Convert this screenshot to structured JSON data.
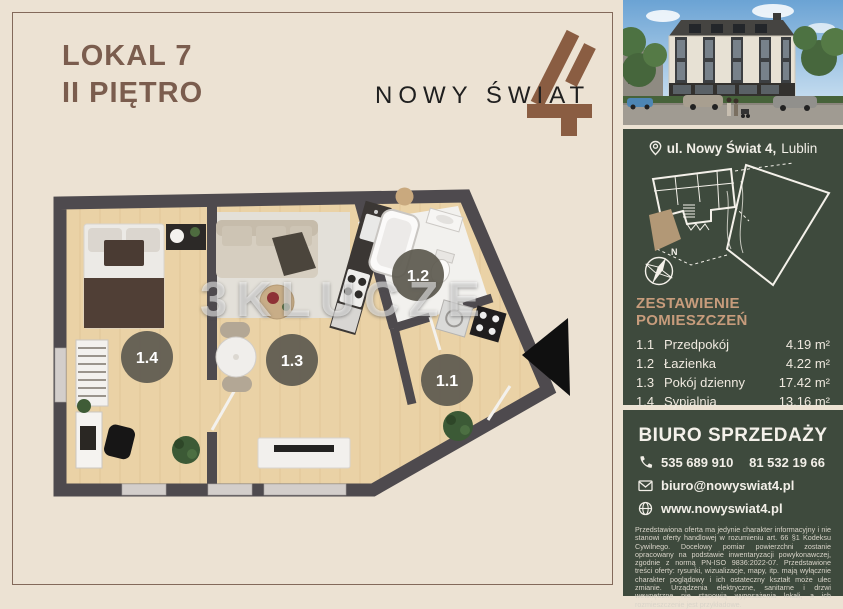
{
  "colors": {
    "background": "#ece2d3",
    "panel_green": "#3e4a3d",
    "accent_tan": "#c79c7c",
    "title_brown": "#7b5d4e",
    "logo_brown": "#8a5d42",
    "wall_gray": "#4e4a4e",
    "highlight_unit_tan": "#b29876"
  },
  "header": {
    "unit": "LOKAL 7",
    "floor": "II PIĘTRO"
  },
  "logo": {
    "text": "NOWY ŚWIAT",
    "numeral": "4"
  },
  "floorplan": {
    "watermark": "3KLUCZE",
    "badges": [
      "1.1",
      "1.2",
      "1.3",
      "1.4"
    ]
  },
  "location": {
    "address_bold": "ul. Nowy Świat 4,",
    "city": "Lublin"
  },
  "siteplan": {
    "north_label": "N"
  },
  "rooms_table": {
    "title": "ZESTAWIENIE POMIESZCZEŃ",
    "rows": [
      {
        "no": "1.1",
        "name": "Przedpokój",
        "area": "4.19 m²"
      },
      {
        "no": "1.2",
        "name": "Łazienka",
        "area": "4.22 m²"
      },
      {
        "no": "1.3",
        "name": "Pokój dzienny",
        "area": "17.42 m²"
      },
      {
        "no": "1.4",
        "name": "Sypialnia",
        "area": "13.16 m²"
      }
    ],
    "total_label": "Powierzchnia użytkowa:",
    "total_value": "38.99 m²"
  },
  "sales_office": {
    "title": "BIURO SPRZEDAŻY",
    "phone_primary": "535 689 910",
    "phone_secondary": "81 532 19 66",
    "email": "biuro@nowyswiat4.pl",
    "website": "www.nowyswiat4.pl"
  },
  "disclaimer": "Przedstawiona oferta ma jedynie charakter informacyjny i nie stanowi oferty handlowej w rozumieniu art. 66 §1 Kodeksu Cywilnego. Docelowy pomiar powierzchni zostanie opracowany na podstawie inwentaryzacji powykonawczej, zgodnie z normą PN-ISO 9836:2022-07. Przedstawione treści oferty: rysunki, wizualizacje, mapy, itp. mają wyłącznie charakter poglądowy i ich ostateczny kształt może ulec zmianie. Urządzenia elektryczne, sanitarne i drzwi wewnętrzne nie stanowią wyposażenia lokali, a ich rozmieszczenie jest przykładowe."
}
